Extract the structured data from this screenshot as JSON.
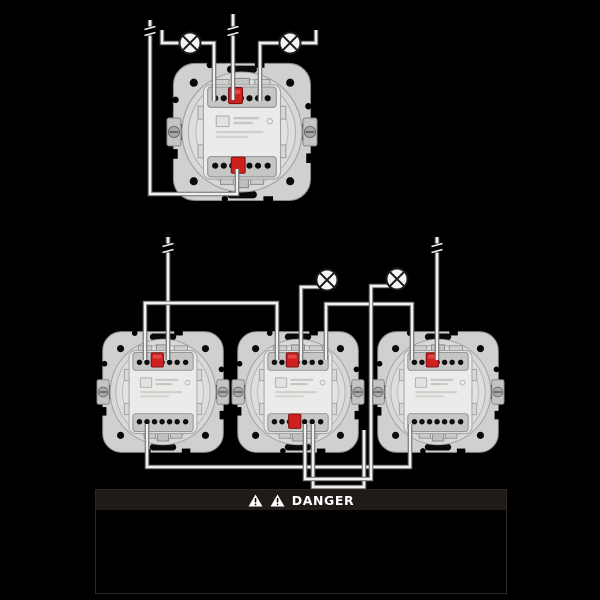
{
  "banner": {
    "title": "DANGER"
  },
  "colors": {
    "background": "#000000",
    "wire_core": "#efefef",
    "wire_edge": "#6b6b6b",
    "lamp_fill": "#f4f4f4",
    "lamp_stroke": "#1b1b1b",
    "plate": "#d0d0d0",
    "module": "#ebebe9",
    "red_button": "#cf2020",
    "red_button_edge": "#801010",
    "banner_bg": "#201b19",
    "banner_text": "#ffffff"
  },
  "diagram": {
    "devices": [
      {
        "name": "switch-mechanism-top",
        "x": 167,
        "y": 57,
        "scale": 1.071,
        "red_bottom": true
      },
      {
        "name": "switch-mechanism-bottom-left",
        "x": 97,
        "y": 326,
        "scale": 0.943,
        "red_bottom": false
      },
      {
        "name": "switch-mechanism-bottom-middle",
        "x": 232,
        "y": 326,
        "scale": 0.943,
        "red_bottom": true
      },
      {
        "name": "switch-mechanism-bottom-right",
        "x": 372,
        "y": 326,
        "scale": 0.943,
        "red_bottom": false
      }
    ],
    "wires": [
      {
        "id": "supply-left-loop",
        "points": [
          [
            150,
            20
          ],
          [
            150,
            194
          ],
          [
            237,
            194
          ],
          [
            237,
            169
          ]
        ]
      },
      {
        "id": "lamp-bus-left",
        "points": [
          [
            162,
            30
          ],
          [
            162,
            43
          ],
          [
            214,
            43
          ],
          [
            214,
            101
          ]
        ]
      },
      {
        "id": "lamp-bus-right",
        "points": [
          [
            260,
            101
          ],
          [
            260,
            43
          ],
          [
            316,
            43
          ],
          [
            316,
            30
          ]
        ]
      },
      {
        "id": "supply-center",
        "points": [
          [
            233,
            14
          ],
          [
            233,
            100
          ]
        ]
      },
      {
        "id": "supply-drop-1",
        "points": [
          [
            168,
            237
          ],
          [
            168,
            360
          ]
        ]
      },
      {
        "id": "supply-drop-3",
        "points": [
          [
            437,
            237
          ],
          [
            437,
            360
          ]
        ]
      },
      {
        "id": "link-bus-a",
        "points": [
          [
            145,
            360
          ],
          [
            145,
            303
          ],
          [
            277,
            303
          ],
          [
            277,
            360
          ]
        ]
      },
      {
        "id": "link-bus-b",
        "points": [
          [
            326,
            360
          ],
          [
            326,
            304
          ],
          [
            412,
            304
          ],
          [
            412,
            360
          ]
        ]
      },
      {
        "id": "lamp1-feed",
        "points": [
          [
            301,
            360
          ],
          [
            301,
            287
          ],
          [
            322,
            287
          ]
        ]
      },
      {
        "id": "bottom-link-long",
        "points": [
          [
            147,
            424
          ],
          [
            147,
            467
          ],
          [
            410,
            467
          ],
          [
            410,
            424
          ]
        ]
      },
      {
        "id": "bottom-link-inner",
        "points": [
          [
            313,
            424
          ],
          [
            313,
            487
          ],
          [
            364,
            487
          ],
          [
            364,
            430
          ]
        ]
      },
      {
        "id": "lamp2-feed",
        "points": [
          [
            305,
            424
          ],
          [
            305,
            479
          ],
          [
            371,
            479
          ],
          [
            371,
            286
          ],
          [
            389,
            286
          ]
        ]
      }
    ],
    "breaks": [
      {
        "x": 150,
        "y": 31
      },
      {
        "x": 233,
        "y": 31
      },
      {
        "x": 168,
        "y": 248
      },
      {
        "x": 437,
        "y": 248
      }
    ],
    "lamps": [
      {
        "cx": 190,
        "cy": 43,
        "r": 10.5
      },
      {
        "cx": 290,
        "cy": 43,
        "r": 10.5
      },
      {
        "cx": 327,
        "cy": 280,
        "r": 10.5
      },
      {
        "cx": 397,
        "cy": 279,
        "r": 10.5
      }
    ]
  }
}
